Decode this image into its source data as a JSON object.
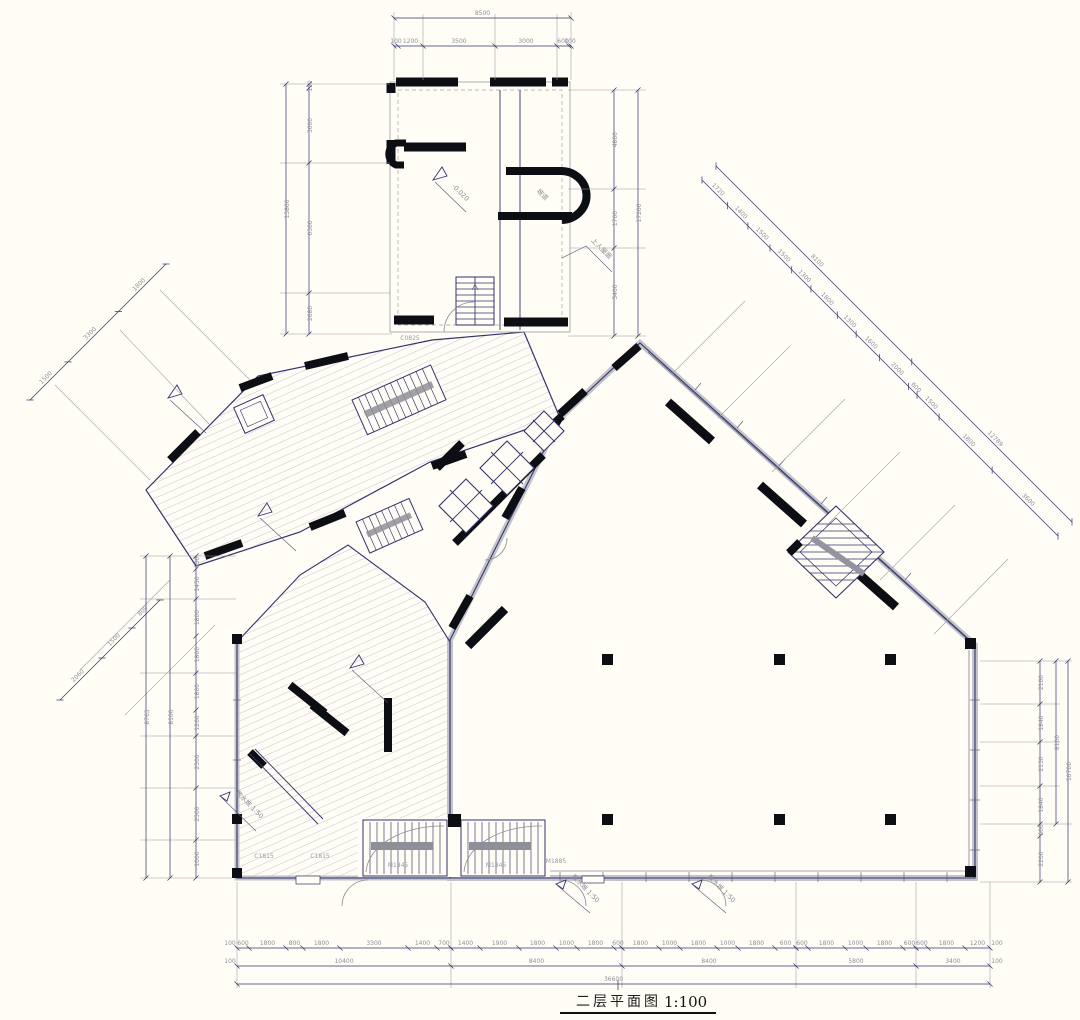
{
  "title": {
    "text": "二层平面图",
    "scale": "1:100"
  },
  "colors": {
    "line": "#33336b",
    "wall": "#0d0d14",
    "hatch": "#b7b7c6",
    "window_band": "#c3c3cb",
    "background": "#fffdf6",
    "dim_text": "#8f8f9c"
  },
  "annotations": {
    "roof_access": "上人屋面",
    "ramp": "坡道",
    "elevation": "-0.020",
    "apron": "散水坡 1:50"
  },
  "codes": {
    "window_1": "C1815",
    "window_2": "C1815",
    "window_3": "C0825",
    "door_1": "M1845",
    "door_2": "M1845",
    "door_3": "M1885"
  },
  "dims": {
    "top": {
      "total": "8500",
      "segments": [
        "100",
        "1200",
        "3500",
        "3000",
        "600",
        "100"
      ]
    },
    "wing_left": {
      "total": "13860",
      "segments": [
        "100",
        "3600",
        "6300",
        "2680"
      ]
    },
    "wing_right": {
      "total": "17200",
      "segments": [
        "4800",
        "1700",
        "5400"
      ]
    },
    "bottom_row1": [
      [
        "600",
        "1800",
        "800",
        "1800",
        "3300",
        "1400",
        "700"
      ],
      [
        "1400",
        "1900",
        "1800",
        "1000",
        "1800",
        "600"
      ],
      [
        "1800",
        "1000",
        "1800",
        "1000",
        "1800",
        "600"
      ],
      [
        "600",
        "1800",
        "1000",
        "1800",
        "600"
      ],
      [
        "600",
        "1800",
        "1200"
      ]
    ],
    "bottom_margins": [
      "100",
      "100",
      "100",
      "100"
    ],
    "bottom_row2": [
      "10400",
      "8400",
      "8400",
      "5800",
      "3400"
    ],
    "bottom_total": "36600",
    "left_chain": {
      "totals": [
        "8763",
        "8100"
      ],
      "segments": [
        "650",
        "1450",
        "1800",
        "1800",
        "1800",
        "1260",
        "2500",
        "2500",
        "1000"
      ]
    },
    "right_chain": {
      "totals": [
        "10700",
        "8100"
      ],
      "segments": [
        "2100",
        "1840",
        "2130",
        "1840",
        "600",
        "2200"
      ]
    },
    "diag_right": {
      "totals": [
        "8100",
        "12789"
      ],
      "segments": [
        "1720",
        "1400",
        "1500",
        "1500",
        "1300",
        "1800",
        "1300",
        "1600",
        "2000",
        "600",
        "1500",
        "1800",
        "3600"
      ]
    },
    "diag_upper_left": {
      "segments": [
        "1500",
        "3300",
        "1800"
      ]
    },
    "diag_lower_left": {
      "segments": [
        "2060",
        "1500",
        "800"
      ]
    }
  }
}
